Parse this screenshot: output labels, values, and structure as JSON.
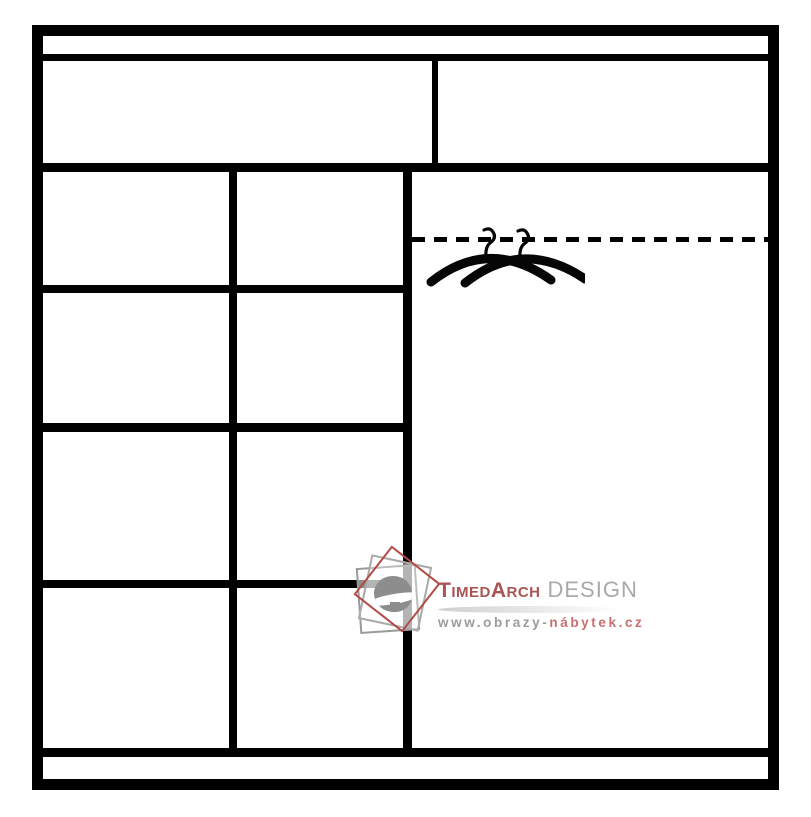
{
  "diagram": {
    "background": "#ffffff",
    "icons": [
      {
        "name": "hanger-icon",
        "count": 2
      },
      {
        "name": "hanging-rail-dashed-line",
        "count": 1
      }
    ]
  },
  "colors": {
    "line_black": "#000000",
    "brand_red": "#ab5454",
    "design_gray": "#a9a9a9",
    "url_gray": "#9c9c9c",
    "url_red": "#c9706f",
    "logo_red": "#b24b47",
    "logo_gray": "#9a9a9a"
  },
  "watermark": {
    "brand_first": "TimedArch",
    "brand_second": "DESIGN",
    "url_prefix": "www.obrazy-",
    "url_suffix": "nábytek.cz"
  }
}
